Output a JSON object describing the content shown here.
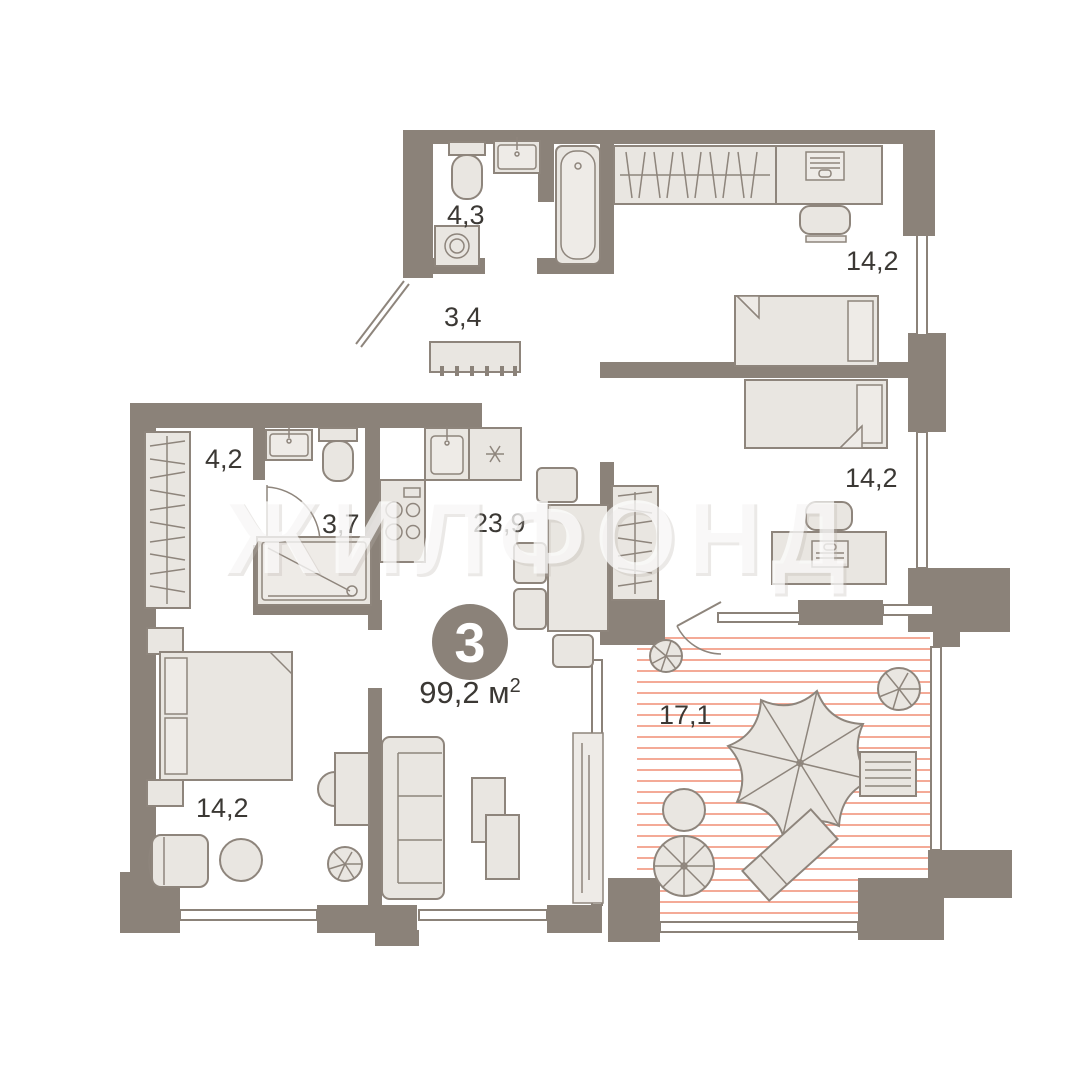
{
  "plan": {
    "watermark": "ЖИЛФОНД",
    "badge": {
      "rooms_count": "3",
      "area_value": "99,2",
      "area_unit": " м",
      "area_superscript": "2"
    },
    "rooms": [
      {
        "id": "bathroom-small",
        "label": "4,3"
      },
      {
        "id": "hallway",
        "label": "3,4"
      },
      {
        "id": "bedroom-top",
        "label": "14,2"
      },
      {
        "id": "bedroom-middle",
        "label": "14,2"
      },
      {
        "id": "wardrobe-hall",
        "label": "4,2"
      },
      {
        "id": "bathroom-shower",
        "label": "3,7"
      },
      {
        "id": "kitchen-living",
        "label": "23,9"
      },
      {
        "id": "bedroom-master",
        "label": "14,2"
      },
      {
        "id": "terrace",
        "label": "17,1"
      }
    ],
    "colors": {
      "wall": "#8b8279",
      "furniture_fill": "#e9e6e1",
      "furniture_stroke": "#8e857c",
      "terrace_hatch": "#f29e88",
      "label_text": "#3b3834",
      "badge_fill": "#8b8279",
      "badge_text": "#ffffff",
      "watermark": "#ffffff"
    }
  }
}
